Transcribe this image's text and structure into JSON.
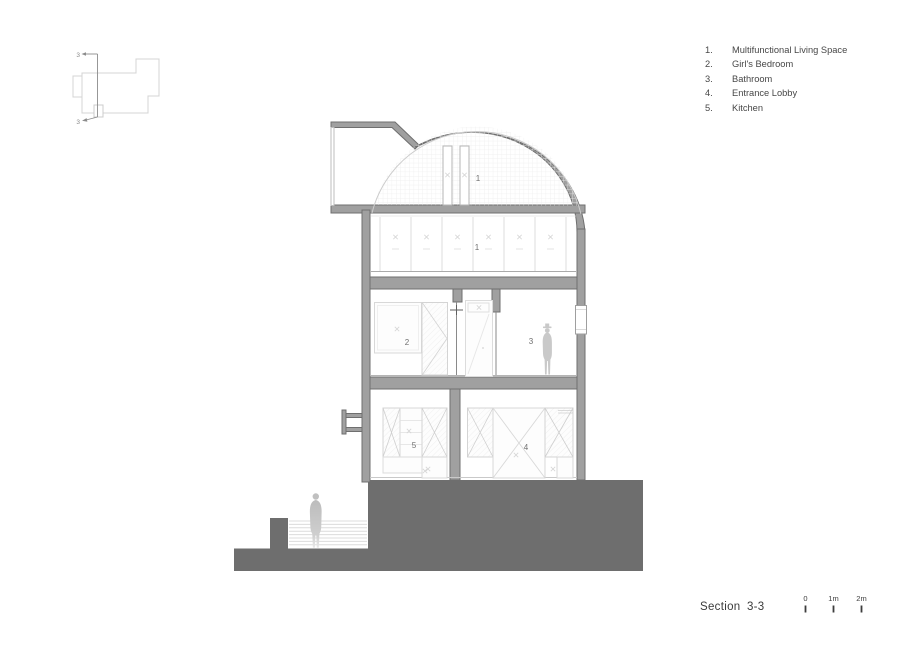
{
  "legend": {
    "items": [
      {
        "num": "1.",
        "label": "Multifunctional Living Space"
      },
      {
        "num": "2.",
        "label": "Girl's Bedroom"
      },
      {
        "num": "3.",
        "label": "Bathroom"
      },
      {
        "num": "4.",
        "label": "Entrance Lobby"
      },
      {
        "num": "5.",
        "label": "Kitchen"
      }
    ]
  },
  "key_plan": {
    "section_marker_top": "3",
    "section_marker_bottom": "3"
  },
  "section": {
    "room_labels": {
      "dome_living": "1",
      "cabinet_living": "1",
      "bedroom": "2",
      "bathroom": "3",
      "lobby": "4",
      "kitchen": "5"
    }
  },
  "title": {
    "label": "Section 3-3"
  },
  "scale_bar": {
    "ticks": [
      "0",
      "1m",
      "2m"
    ]
  },
  "colors": {
    "wall_fill": "#a0a0a0",
    "wall_outline": "#6f6f6f",
    "terrain": "#6e6e6e",
    "furniture_line": "#d5d5d5",
    "grid_line": "#ededed",
    "figure": "#c7c7c7",
    "room_label_text": "#6f6f6f",
    "legend_text": "#474747",
    "title_text": "#3a3a3a"
  }
}
